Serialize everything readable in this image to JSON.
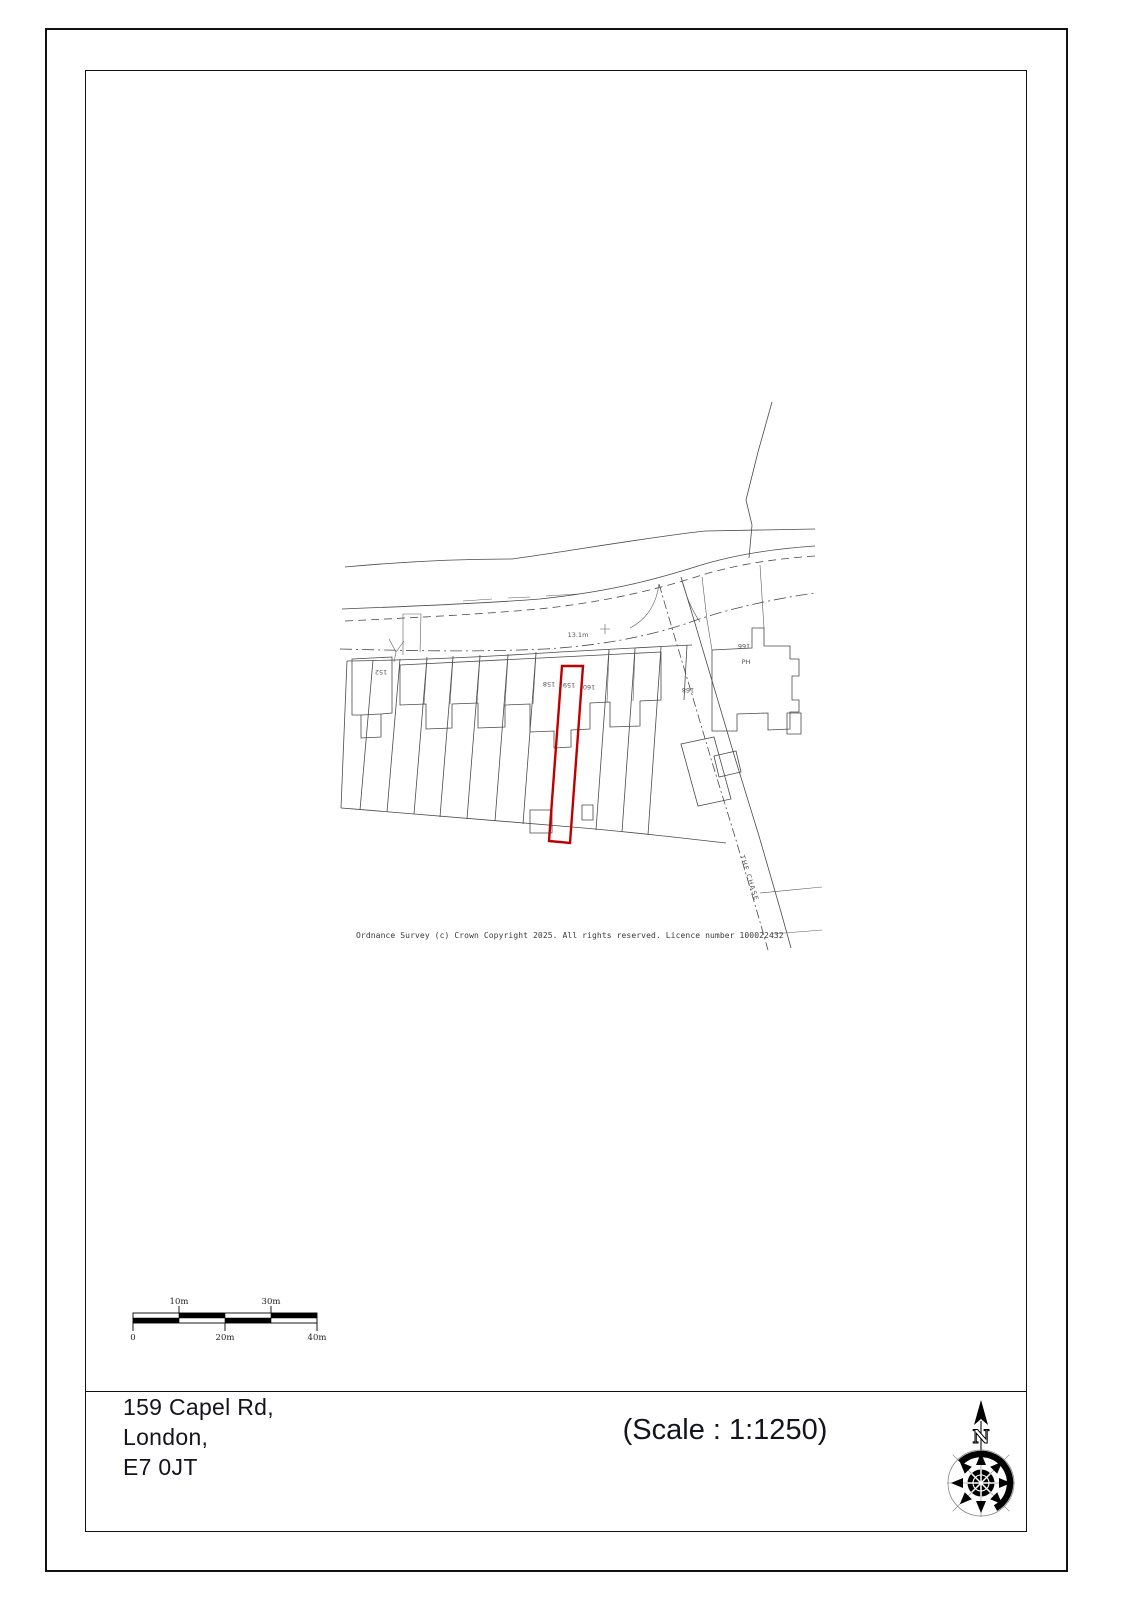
{
  "page": {
    "address_lines": [
      "159 Capel Rd,",
      "London,",
      "E7 0JT"
    ],
    "scale_text": "(Scale : 1:1250)",
    "compass": {
      "north_label": "N"
    }
  },
  "map": {
    "copyright": "Ordnance Survey (c) Crown Copyright 2025. All rights reserved. Licence number 100022432",
    "spot_height": "13.1m",
    "street_name": "THE CHASE",
    "highlight_color": "#c00000",
    "labels": {
      "plot_152": "152",
      "plot_158": "158",
      "plot_159": "159",
      "plot_160": "160",
      "plot_168": "168",
      "plot_166": "166",
      "pub": "PH"
    }
  },
  "scale_bar": {
    "top_labels": [
      "10m",
      "30m"
    ],
    "bottom_labels": [
      "0",
      "20m",
      "40m"
    ]
  }
}
